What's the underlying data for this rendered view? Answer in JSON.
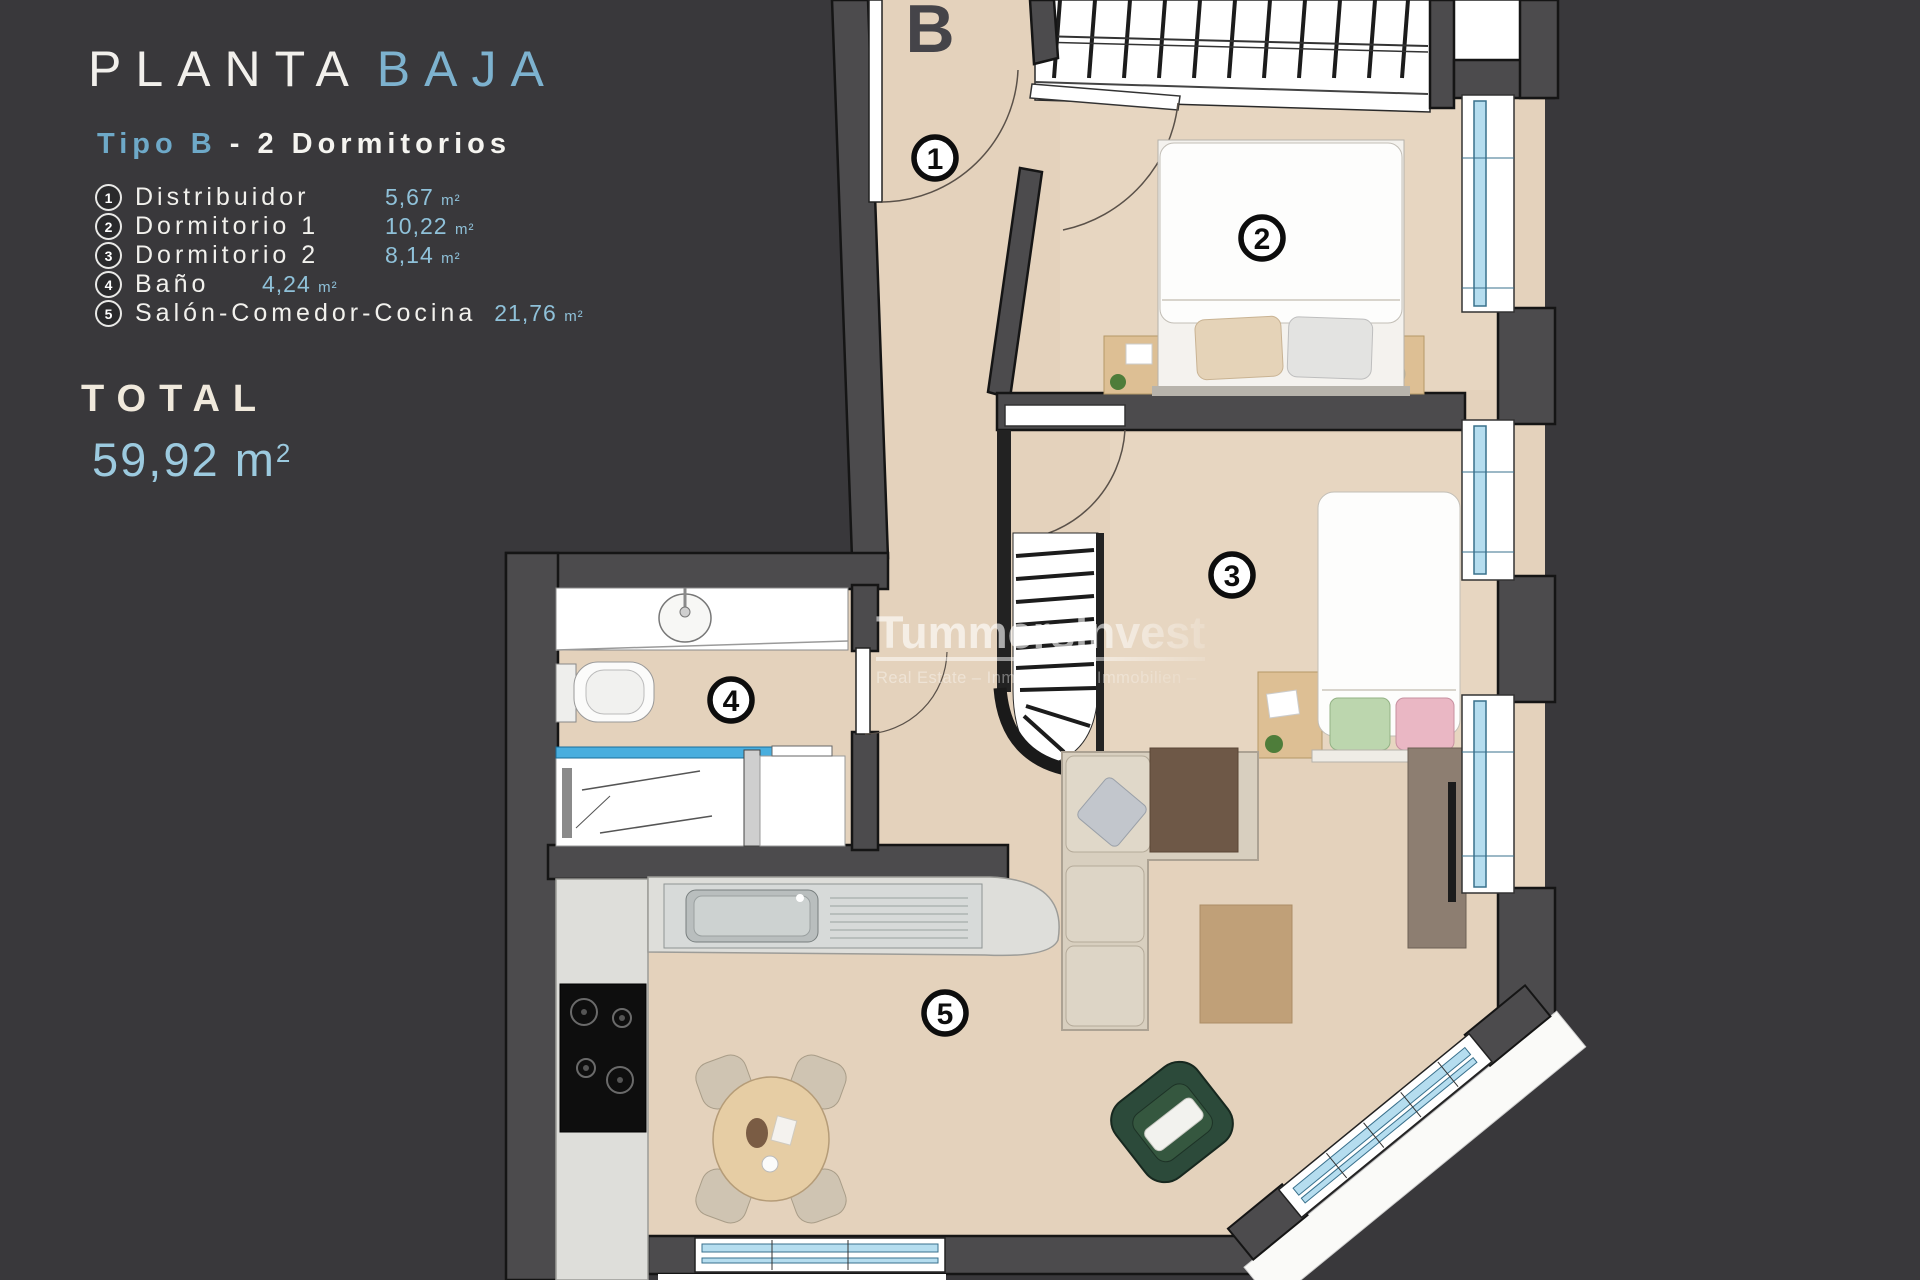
{
  "panel": {
    "title": {
      "main": "PLANTA",
      "accent": "BAJA"
    },
    "subtitle": {
      "accent": "Tipo B",
      "rest": " - 2 Dormitorios"
    },
    "legend": [
      {
        "num": "1",
        "name": "Distribuidor",
        "area": "5,67",
        "unit": "m²"
      },
      {
        "num": "2",
        "name": "Dormitorio 1",
        "area": "10,22",
        "unit": "m²"
      },
      {
        "num": "3",
        "name": "Dormitorio 2",
        "area": "8,14",
        "unit": "m²"
      },
      {
        "num": "4",
        "name": "Baño",
        "area": "4,24",
        "unit": "m²"
      },
      {
        "num": "5",
        "name": "Salón-Comedor-Cocina",
        "area": "21,76",
        "unit": "m²"
      }
    ],
    "total": {
      "label": "TOTAL",
      "value": "59,92",
      "unit_base": "m",
      "unit_sup": "2"
    }
  },
  "plan": {
    "block_label": "B",
    "markers": {
      "m1": "1",
      "m2": "2",
      "m3": "3",
      "m4": "4",
      "m5": "5"
    },
    "rooms": [
      "Distribuidor",
      "Dormitorio 1",
      "Dormitorio 2",
      "Baño",
      "Salón-Comedor-Cocina"
    ],
    "watermark": {
      "brand": "TummersInvest",
      "tagline": "Real Estate – Inmobiliaria – Immobilien –"
    }
  },
  "colors": {
    "background": "#39383b",
    "accent_blue": "#7db2cf",
    "area_blue": "#8fc1d9",
    "cream": "#f0e9dc",
    "floor": "#e4d2bc",
    "wall": "#4c4b4d",
    "glazing": "#b5ddef",
    "counter": "#dededa",
    "sofa": "#d8cfbf",
    "armchair": "#2c4a3a",
    "wood": "#ddbf94"
  }
}
